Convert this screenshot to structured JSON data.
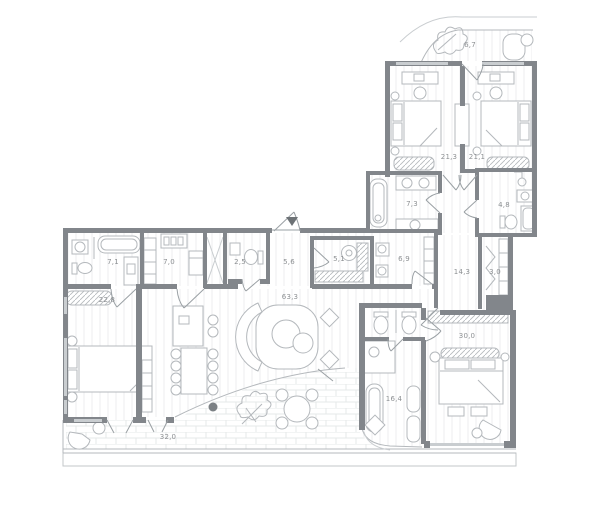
{
  "page": {
    "background": "#ffffff",
    "type_label": "apartment-floor-plan"
  },
  "colors": {
    "wall": "#82868b",
    "furniture_line": "#b4b8bc",
    "floor_hatch": "#eceeef",
    "label_text": "#8d9093",
    "window": "#c9cdd0",
    "entry_marker": "#6d7276"
  },
  "plan": {
    "rooms": [
      {
        "id": "balcony",
        "area_label": "6,7"
      },
      {
        "id": "bedroom-1",
        "area_label": "21,3"
      },
      {
        "id": "bedroom-2",
        "area_label": "21,1"
      },
      {
        "id": "bathroom-1",
        "area_label": "7,3"
      },
      {
        "id": "shower-room",
        "area_label": "4,8"
      },
      {
        "id": "bathroom-2",
        "area_label": "7,1"
      },
      {
        "id": "kitchen",
        "area_label": "7,0"
      },
      {
        "id": "wc",
        "area_label": "2,5"
      },
      {
        "id": "entry-hall",
        "area_label": "5,6"
      },
      {
        "id": "wardrobe",
        "area_label": "5,1"
      },
      {
        "id": "bathroom-3",
        "area_label": "6,9"
      },
      {
        "id": "corridor",
        "area_label": "14,3"
      },
      {
        "id": "closet",
        "area_label": "3,0"
      },
      {
        "id": "bedroom-3",
        "area_label": "22,8"
      },
      {
        "id": "living-room",
        "area_label": "63,3"
      },
      {
        "id": "master-bathroom",
        "area_label": "16,4"
      },
      {
        "id": "master-bedroom",
        "area_label": "30,0"
      },
      {
        "id": "terrace",
        "area_label": "32,0"
      }
    ]
  }
}
